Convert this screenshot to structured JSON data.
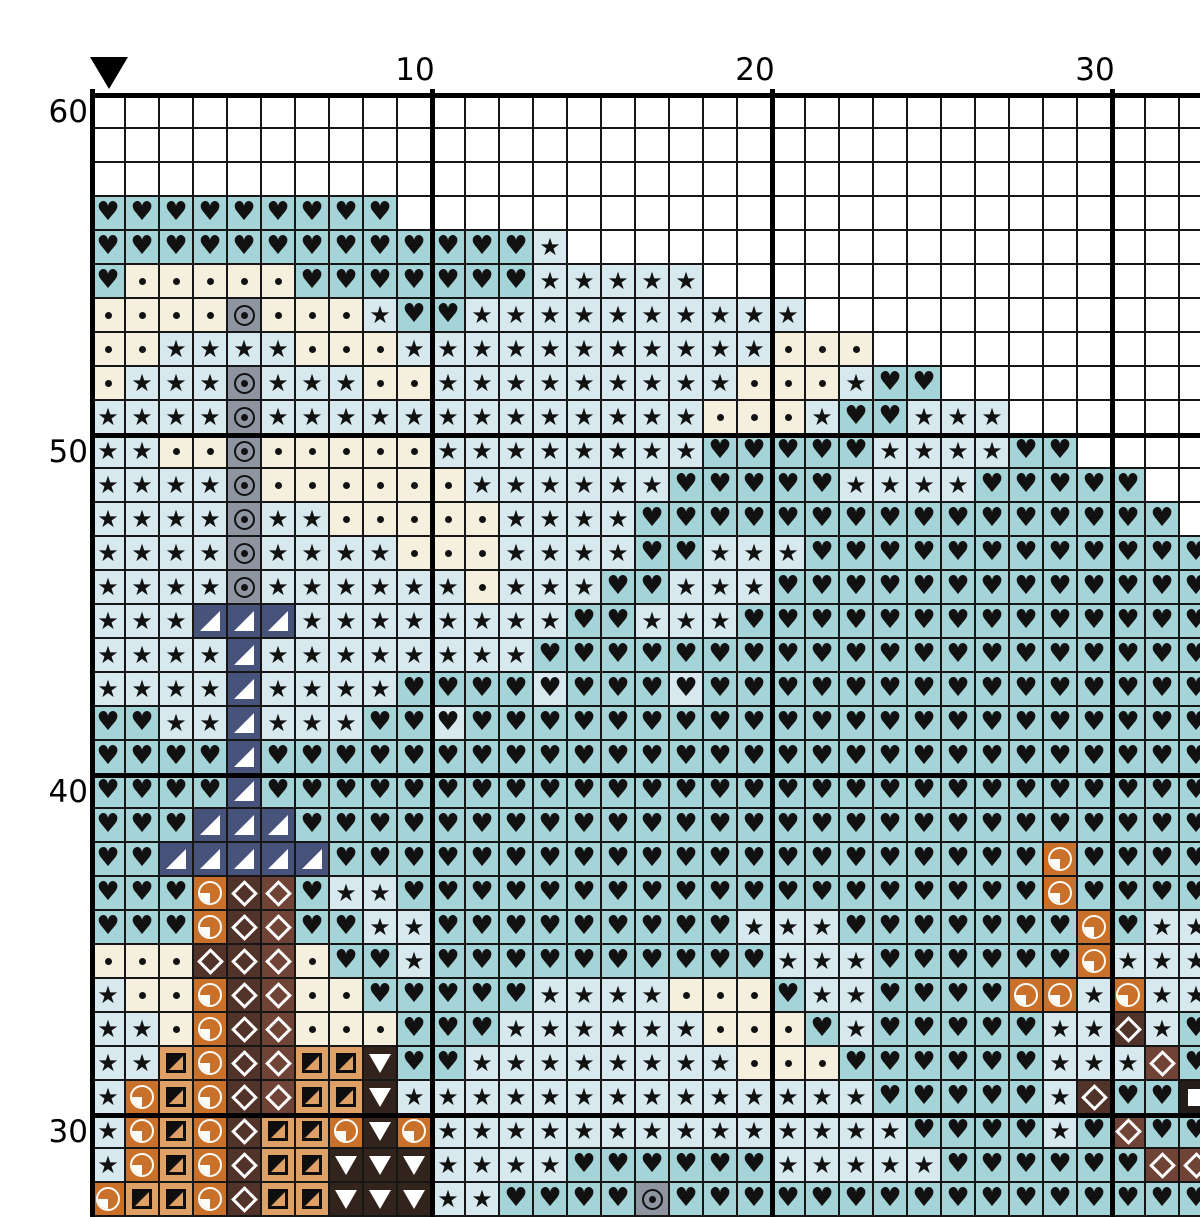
{
  "axis": {
    "top_labels": [
      {
        "text": "10",
        "col": 10
      },
      {
        "text": "20",
        "col": 20
      },
      {
        "text": "30",
        "col": 30
      }
    ],
    "left_labels": [
      {
        "text": "60",
        "row": 60
      },
      {
        "text": "50",
        "row": 50
      },
      {
        "text": "40",
        "row": 40
      },
      {
        "text": "30",
        "row": 30
      }
    ]
  },
  "marker": {
    "name": "center-marker",
    "col": 1
  },
  "palette": {
    "w": {
      "bg": "#ffffff",
      "symbol": "none",
      "meaning": "empty"
    },
    "h": {
      "bg": "#d7e9ee",
      "symbol": "heart",
      "meaning": "heart on pale blue"
    },
    "H": {
      "bg": "#a5d4d8",
      "symbol": "heart",
      "meaning": "heart on teal"
    },
    "s": {
      "bg": "#d7e9ee",
      "symbol": "star",
      "meaning": "star on pale blue"
    },
    "d": {
      "bg": "#f4f0dd",
      "symbol": "dot",
      "meaning": "dot on cream"
    },
    "g": {
      "bg": "#8e95a1",
      "symbol": "fisheye",
      "meaning": "circled dot on gray"
    },
    "n": {
      "bg": "#47537a",
      "symbol": "triangle-lower-right-white",
      "meaning": "white triangle on navy"
    },
    "q": {
      "bg": "#c9712a",
      "symbol": "quarter-circle",
      "meaning": "quarter circle on orange"
    },
    "x": {
      "bg": "#523329",
      "symbol": "diamond-outline",
      "meaning": "diamond on dark brown"
    },
    "X": {
      "bg": "#6f4437",
      "symbol": "diamond-outline",
      "meaning": "diamond on red brown"
    },
    "r": {
      "bg": "#dfa066",
      "symbol": "square-diagonal",
      "meaning": "half square on tan"
    },
    "v": {
      "bg": "#32241d",
      "symbol": "triangle-down-white",
      "meaning": "white down triangle on dark brown"
    },
    "Q": {
      "bg": "#221d19",
      "symbol": "square-white",
      "meaning": "white square on black brown"
    }
  },
  "grid": {
    "cell_px": 34,
    "origin_x": 92,
    "origin_y": 95,
    "thick_every": 10,
    "start_row": 60,
    "start_col": 1,
    "cols": 33,
    "rows": [
      {
        "row": 60,
        "cells": "wwwwwwwwwwwwwwwwwwwwwwwwwwwwwwwww"
      },
      {
        "row": 59,
        "cells": "wwwwwwwwwwwwwwwwwwwwwwwwwwwwwwwww"
      },
      {
        "row": 58,
        "cells": "wwwwwwwwwwwwwwwwwwwwwwwwwwwwwwwww"
      },
      {
        "row": 57,
        "cells": "HHHHHHHHHwwwwwwwwwwwwwwwwwwwwwwww"
      },
      {
        "row": 56,
        "cells": "HHHHHHHHHHHHHswwwwwwwwwwwwwwwwwww"
      },
      {
        "row": 55,
        "cells": "HdddddHHHHHHHssssswwwwwwwwwwwwwww"
      },
      {
        "row": 54,
        "cells": "ddddgdddsHHsssssssssswwwwwwwwwwww"
      },
      {
        "row": 53,
        "cells": "ddssssdddsssssssssssdddwwwwwwwwww"
      },
      {
        "row": 52,
        "cells": "dsssgsssddsssssssssdddsHHwwwwwwww"
      },
      {
        "row": 51,
        "cells": "ssssgsssssssssssssdddsHHssswwwwww"
      },
      {
        "row": 50,
        "cells": "ssddgdddddssssssssHHHHHssssHHwwww"
      },
      {
        "row": 49,
        "cells": "ssssgddddddssssssHHHHHssssHHHHHww"
      },
      {
        "row": 48,
        "cells": "ssssgssdddddssssHHHHHHHHHHHHHHHHw"
      },
      {
        "row": 47,
        "cells": "ssssgssssdddssssHHsssHHHHHHHHHHHH"
      },
      {
        "row": 46,
        "cells": "ssssgssssssdsssHHsssHHHHHHHHHHHHH"
      },
      {
        "row": 45,
        "cells": "sssnnnssssssssHHsssHHHHHHHHHHHHHH"
      },
      {
        "row": 44,
        "cells": "ssssnssssssssHHHHHHHHHHHHHHHHHHHH"
      },
      {
        "row": 43,
        "cells": "ssssnssssHHHHhHHHhHHHHHHHHHHHHHHH"
      },
      {
        "row": 42,
        "cells": "HHssnsssHHhHHHHHHHHHHHHHHHHHHHHHH"
      },
      {
        "row": 41,
        "cells": "HHHHnHHHHHHHHHHHHHHHHHHHHHHHHHHHH"
      },
      {
        "row": 40,
        "cells": "HHHHnHHHHHHHHHHHHHHHHHHHHHHHHHHHH"
      },
      {
        "row": 39,
        "cells": "HHHnnnHHHHHHHHHHHHHHHHHHHHHHHHHHH"
      },
      {
        "row": 38,
        "cells": "HHnnnnnHHHHHHHHHHHHHHHHHHHHHqHHHH"
      },
      {
        "row": 37,
        "cells": "HHHqxXHssHHHHHHHHHHHHHHHHHHHqHHHH"
      },
      {
        "row": 36,
        "cells": "HHHqxXHHssHHHHHHHHHsssHHHHHHHqHss"
      },
      {
        "row": 35,
        "cells": "dddxxXdHHsHHHHHHHHHHsssHHHHHHqsss"
      },
      {
        "row": 34,
        "cells": "sddqxXddHHHHHssssdddHssHHHHqqsqss"
      },
      {
        "row": 33,
        "cells": "ssdqxXdddHHHssssssdddHsHHHHHssxsH"
      },
      {
        "row": 32,
        "cells": "ssrqxXrrvHHssssssssdddHHHHHHsssXH"
      },
      {
        "row": 31,
        "cells": "sqrqxXrrvssssssssssssssHHHHHsxHHQ"
      },
      {
        "row": 30,
        "cells": "sqrqxrrqvqssssssssssssssHHHHsHXHH"
      },
      {
        "row": 29,
        "cells": "sqrqxrrvvvssssHHHHHHsssssHHHHHHXX"
      },
      {
        "row": 28,
        "cells": "qrrqxrrvvvssHHHHgHHHHHHHHHHHHHHHH"
      }
    ]
  },
  "line_colors": {
    "thin": "#161616",
    "thick": "#000000"
  },
  "symbol_glyphs": {
    "heart": "♥",
    "star": "★"
  }
}
